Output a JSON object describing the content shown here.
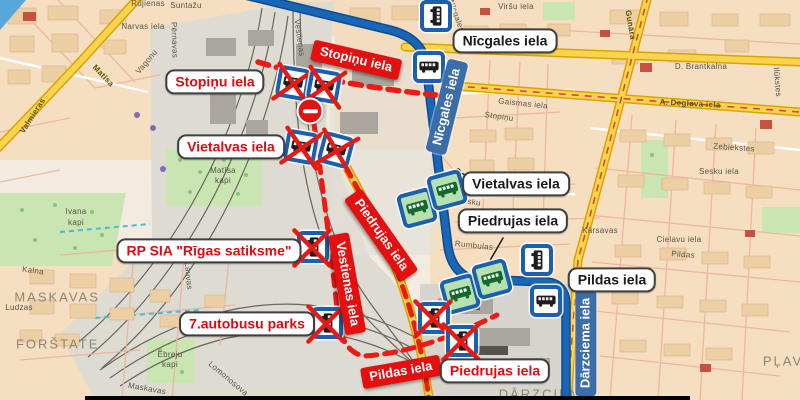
{
  "colors": {
    "blue_route": "#1a66b6",
    "detour_red": "#ee1b15",
    "banner_red": "#e60f0f",
    "route_label_blue": "#3b6da8",
    "stop_border_blue": "#1b5fae",
    "new_stop_green": "#b7e0b0",
    "road_yellow": "#fbd44f",
    "map_background": "#f1ecdf"
  },
  "icons": {
    "bus_stop": "blue-bordered white square with bus glyph",
    "new_bus_stop": "blue-bordered green square with bus glyph",
    "closed_bus_stop": "bus stop crossed with red X",
    "no_entry": "red circle with white bar"
  },
  "overlay": {
    "callouts": [
      {
        "text": "Nīcgales iela"
      },
      {
        "text": "Vietalvas iela"
      },
      {
        "text": "Piedrujas iela"
      },
      {
        "text": "Pildas iela"
      },
      {
        "text": "Stopiņu iela"
      },
      {
        "text": "Vietalvas iela"
      },
      {
        "text": "RP SIA \"Rīgas satiksme\""
      },
      {
        "text": "7.autobusu parks"
      },
      {
        "text": "Piedrujas iela"
      }
    ],
    "banners": [
      {
        "text": "Stopiņu iela"
      },
      {
        "text": "Piedrujas iela"
      },
      {
        "text": "Vestienas iela"
      },
      {
        "text": "Pildas iela"
      }
    ],
    "route_labels": [
      {
        "text": "Nīcgales iela"
      },
      {
        "text": "Dārzciema iela"
      }
    ]
  },
  "base_map": {
    "street_labels": [
      {
        "text": "Rūjienas"
      },
      {
        "text": "Suntažu"
      },
      {
        "text": "Narvas iela"
      },
      {
        "text": "Pērnavas"
      },
      {
        "text": "Vagonu"
      },
      {
        "text": "Matīsa"
      },
      {
        "text": "Valmieras"
      },
      {
        "text": "Vestienas"
      },
      {
        "text": "Matīsa"
      },
      {
        "text": "kapi"
      },
      {
        "text": "Ivana"
      },
      {
        "text": "kapi"
      },
      {
        "text": "Kalna"
      },
      {
        "text": "MASKAVAS"
      },
      {
        "text": "Ludzas"
      },
      {
        "text": "FORŠTATE"
      },
      {
        "text": "Lauvas"
      },
      {
        "text": "Ebreju"
      },
      {
        "text": "kapi"
      },
      {
        "text": "Maskavas"
      },
      {
        "text": "Lomonosova"
      },
      {
        "text": "Stopiņu"
      },
      {
        "text": "Gaismas iela"
      },
      {
        "text": "Sesku"
      },
      {
        "text": "Rumbulas"
      },
      {
        "text": "Kārsavas"
      },
      {
        "text": "Cielavu iela"
      },
      {
        "text": "Pildas"
      },
      {
        "text": "Sesku iela"
      },
      {
        "text": "Zebiekstes"
      },
      {
        "text": "A. Deglava iela"
      },
      {
        "text": "Gunāra"
      },
      {
        "text": "D. Brantkalna"
      },
      {
        "text": "Ilūkstes"
      },
      {
        "text": "Viršu iela"
      },
      {
        "text": "Nīcgales"
      },
      {
        "text": "DĀRZCIEMS"
      },
      {
        "text": "PĻAV"
      }
    ]
  }
}
